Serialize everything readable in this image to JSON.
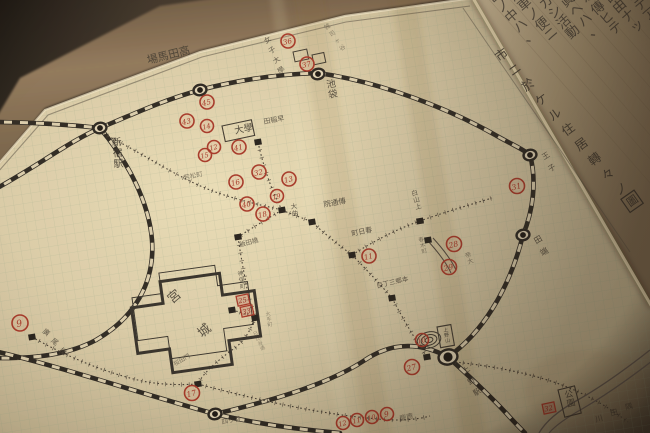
{
  "meta": {
    "width": 650,
    "height": 433,
    "scene": "photo of hand-drawn Tokyo residence map on graph paper over wooden desk, diary page with calligraphy at upper right"
  },
  "palette": {
    "wood": "#33291e",
    "paper": "#d5c6a2",
    "paper_bright": "#e8dbb6",
    "grid": "#8aa083",
    "ink": "#3a332a",
    "red": "#a33122",
    "pencil": "#5a5043",
    "diary_paper": "#a8967a"
  },
  "title": {
    "visible_chars": "市ニ於ケル住居轉々ノ",
    "boxed_char": "圖"
  },
  "calligraphy_columns": [
    "世ノ中ハ、",
    "汽車ノ便ニ",
    "シカシ活動",
    "寫眞ヘハ、",
    "所々傳ヒテ",
    "不自由ナッ",
    "タノデアル。"
  ],
  "palace": {
    "char1": "宮",
    "char2": "城"
  },
  "river_label": "川田隅",
  "railways": [
    {
      "d": "M -10 192 C 35 168 68 142 100 128 C 138 112 164 100 200 90 C 242 79 282 74 318 73"
    },
    {
      "d": "M -12 122 C 25 122 62 124 100 128"
    },
    {
      "d": "M 318 73 C 382 82 452 110 497 136 C 513 145 523 149 530 155 C 537 181 533 211 523 235 C 509 291 481 334 448 357"
    },
    {
      "d": "M 448 357 C 469 376 491 397 506 413 C 514 422 520 428 525 433"
    },
    {
      "d": "M 100 128 C 129 163 149 203 152 240 C 155 281 136 317 96 340 C 70 354 38 359 -8 358"
    },
    {
      "d": "M -10 350 C 60 366 142 394 215 414 C 262 425 304 430 340 433"
    },
    {
      "d": "M 215 414 C 280 399 332 382 365 360 C 392 342 420 342 448 357"
    }
  ],
  "trams": [
    {
      "d": "M 100 132 C 140 152 166 170 196 184 C 224 197 252 203 282 210"
    },
    {
      "d": "M 258 142 C 263 165 271 190 282 210"
    },
    {
      "d": "M 282 210 C 293 215 303 218 312 222 C 327 236 339 245 352 255 C 366 269 379 283 392 298 C 402 317 414 338 427 357"
    },
    {
      "d": "M 352 255 C 374 241 397 229 420 221 C 442 213 466 206 492 198"
    },
    {
      "d": "M 282 210 C 267 219 252 228 238 237"
    },
    {
      "d": "M 238 237 C 241 258 245 278 248 294 C 250 302 252 308 255 315 C 252 330 243 343 232 350 C 216 362 203 373 198 384"
    },
    {
      "d": "M 32 337 C 62 354 102 372 142 381 C 162 385 181 385 198 384"
    },
    {
      "d": "M 198 384 C 258 400 318 414 378 419 C 398 421 416 420 430 416"
    },
    {
      "d": "M 455 362 C 492 366 530 373 562 385 C 588 395 610 408 628 422"
    },
    {
      "d": "M 232 310 C 240 312 248 315 255 318"
    }
  ],
  "roads": [
    {
      "d": "M 428 241 C 438 252 446 262 451 273"
    },
    {
      "d": "M 433 238 C 443 249 451 259 456 270"
    }
  ],
  "river_paths": [
    {
      "d": "M 650 350 C 626 369 601 387 576 401 C 558 411 546 421 539 433"
    },
    {
      "d": "M 652 361 C 630 378 606 395 582 409 C 566 418 555 426 549 433"
    }
  ],
  "stations": [
    {
      "x": 100,
      "y": 128,
      "big": false
    },
    {
      "x": 200,
      "y": 90,
      "big": false
    },
    {
      "x": 318,
      "y": 74,
      "big": false
    },
    {
      "x": 530,
      "y": 155,
      "big": false
    },
    {
      "x": 523,
      "y": 235,
      "big": false
    },
    {
      "x": 448,
      "y": 357,
      "big": true
    },
    {
      "x": 215,
      "y": 414,
      "big": false
    }
  ],
  "junctions": [
    [
      32,
      337
    ],
    [
      258,
      142
    ],
    [
      282,
      210
    ],
    [
      238,
      237
    ],
    [
      312,
      222
    ],
    [
      352,
      255
    ],
    [
      420,
      221
    ],
    [
      428,
      240
    ],
    [
      392,
      298
    ],
    [
      232,
      310
    ],
    [
      255,
      318
    ],
    [
      427,
      357
    ],
    [
      198,
      384
    ]
  ],
  "red_circles": [
    {
      "x": 20,
      "y": 323,
      "n": "9",
      "r": 8
    },
    {
      "x": 192,
      "y": 393,
      "n": "17",
      "r": 7.5
    },
    {
      "x": 288,
      "y": 41,
      "n": "36",
      "r": 7
    },
    {
      "x": 307,
      "y": 64,
      "n": "37",
      "r": 7
    },
    {
      "x": 207,
      "y": 102,
      "n": "45",
      "r": 7
    },
    {
      "x": 187,
      "y": 121,
      "n": "43",
      "r": 7
    },
    {
      "x": 207,
      "y": 126,
      "n": "14",
      "r": 6.5
    },
    {
      "x": 214,
      "y": 147,
      "n": "12",
      "r": 6.5
    },
    {
      "x": 239,
      "y": 147,
      "n": "41",
      "r": 7
    },
    {
      "x": 205,
      "y": 155,
      "n": "15",
      "r": 6.5
    },
    {
      "x": 236,
      "y": 182,
      "n": "16",
      "r": 7
    },
    {
      "x": 259,
      "y": 172,
      "n": "32",
      "r": 7
    },
    {
      "x": 289,
      "y": 179,
      "n": "13",
      "r": 7
    },
    {
      "x": 277,
      "y": 196,
      "n": "19",
      "r": 6.5
    },
    {
      "x": 247,
      "y": 204,
      "n": "40",
      "r": 7
    },
    {
      "x": 263,
      "y": 214,
      "n": "18",
      "r": 7
    },
    {
      "x": 369,
      "y": 256,
      "n": "11",
      "r": 7
    },
    {
      "x": 454,
      "y": 244,
      "n": "28",
      "r": 7.5
    },
    {
      "x": 449,
      "y": 267,
      "n": "29",
      "r": 7.5
    },
    {
      "x": 517,
      "y": 186,
      "n": "31",
      "r": 7.5
    },
    {
      "x": 422,
      "y": 340,
      "n": "10",
      "r": 6.5
    },
    {
      "x": 412,
      "y": 367,
      "n": "27",
      "r": 7.5
    },
    {
      "x": 387,
      "y": 414,
      "n": "9",
      "r": 6.5
    },
    {
      "x": 372,
      "y": 417,
      "n": "10",
      "r": 6.5
    },
    {
      "x": 357,
      "y": 420,
      "n": "11",
      "r": 6.5
    },
    {
      "x": 343,
      "y": 423,
      "n": "12",
      "r": 6.5
    }
  ],
  "red_boxes": [
    {
      "x": 243,
      "y": 300,
      "n": "25"
    },
    {
      "x": 247,
      "y": 311,
      "n": "33"
    },
    {
      "x": 549,
      "y": 408,
      "n": "32"
    }
  ],
  "ink_boxes": [
    [
      293,
      52,
      14,
      10,
      -12
    ],
    [
      312,
      55,
      12,
      10,
      -12
    ]
  ],
  "boxed_labels": [
    {
      "t": "大學",
      "x": 222,
      "y": 126,
      "w": 30,
      "h": 16,
      "rot": -12,
      "s": 9.5,
      "dir": "h"
    },
    {
      "t": "公園",
      "x": 558,
      "y": 390,
      "w": 17,
      "h": 28,
      "rot": -14,
      "s": 8.5,
      "dir": "v"
    },
    {
      "t": "上野山",
      "x": 437,
      "y": 327,
      "w": 14,
      "h": 21,
      "rot": -10,
      "s": 5,
      "dir": "v"
    }
  ],
  "labels": [
    {
      "t": "場馬田高",
      "x": 148,
      "y": 64,
      "rot": -14,
      "s": 11,
      "dir": "h",
      "o": 0.85
    },
    {
      "t": "新宿駅",
      "x": 112,
      "y": 146,
      "rot": -5,
      "s": 10,
      "dir": "v",
      "o": 0.9
    },
    {
      "t": "池袋",
      "x": 327,
      "y": 88,
      "rot": -10,
      "s": 9.5,
      "dir": "v",
      "o": 0.85
    },
    {
      "t": "女子大學",
      "x": 266,
      "y": 44,
      "rot": 0,
      "s": 7,
      "dir": "d",
      "step": [
        4.5,
        10
      ],
      "crot": -35,
      "o": 0.8
    },
    {
      "t": "雑司ヶ谷",
      "x": 326,
      "y": 30,
      "rot": 0,
      "s": 6,
      "dir": "d",
      "step": [
        5,
        7
      ],
      "crot": -35,
      "o": 0.5
    },
    {
      "t": "田稲早",
      "x": 264,
      "y": 124,
      "rot": -10,
      "s": 7,
      "dir": "h",
      "o": 0.8
    },
    {
      "t": "若松町",
      "x": 184,
      "y": 180,
      "rot": -12,
      "s": 6.5,
      "dir": "h",
      "o": 0.6
    },
    {
      "t": "大曲",
      "x": 291,
      "y": 209,
      "rot": -8,
      "s": 6.5,
      "dir": "v",
      "o": 0.8
    },
    {
      "t": "飯田橋",
      "x": 240,
      "y": 247,
      "rot": -15,
      "s": 6.5,
      "dir": "h",
      "o": 0.75
    },
    {
      "t": "院通傳",
      "x": 324,
      "y": 207,
      "rot": -10,
      "s": 7.5,
      "dir": "h",
      "o": 0.85
    },
    {
      "t": "白山上",
      "x": 412,
      "y": 196,
      "rot": -15,
      "s": 6.5,
      "dir": "v",
      "o": 0.8
    },
    {
      "t": "町日春",
      "x": 352,
      "y": 236,
      "rot": -12,
      "s": 7,
      "dir": "h",
      "o": 0.85
    },
    {
      "t": "春木町",
      "x": 419,
      "y": 242,
      "rot": -15,
      "s": 5.5,
      "dir": "v",
      "o": 0.6
    },
    {
      "t": "目丁三郷本",
      "x": 377,
      "y": 288,
      "rot": -13,
      "s": 6.5,
      "dir": "h",
      "o": 0.8
    },
    {
      "t": "帝大",
      "x": 466,
      "y": 258,
      "rot": -20,
      "s": 6,
      "dir": "v",
      "o": 0.6
    },
    {
      "t": "神保町",
      "x": 238,
      "y": 276,
      "rot": -10,
      "s": 6,
      "dir": "v",
      "o": 0.75
    },
    {
      "t": "桜田門",
      "x": 175,
      "y": 366,
      "rot": -30,
      "s": 6,
      "dir": "h",
      "o": 0.6
    },
    {
      "t": "廣尾橋",
      "x": 42,
      "y": 332,
      "rot": 0,
      "s": 7,
      "dir": "d",
      "step": [
        8.5,
        9.5
      ],
      "crot": 38,
      "o": 0.8
    },
    {
      "t": "王子",
      "x": 544,
      "y": 160,
      "rot": 0,
      "s": 7.5,
      "dir": "d",
      "step": [
        6,
        12
      ],
      "crot": -33,
      "o": 0.8
    },
    {
      "t": "田端",
      "x": 536,
      "y": 244,
      "rot": 0,
      "s": 8,
      "dir": "d",
      "step": [
        6,
        12
      ],
      "crot": -30,
      "o": 0.85
    },
    {
      "t": "上野駅",
      "x": 464,
      "y": 374,
      "rot": 0,
      "s": 7.5,
      "dir": "d",
      "step": [
        5.5,
        11
      ],
      "crot": -30,
      "o": 0.85
    },
    {
      "t": "四ッ谷",
      "x": 222,
      "y": 424,
      "rot": -10,
      "s": 6.5,
      "dir": "h",
      "o": 0.7
    },
    {
      "t": "慶應",
      "x": 400,
      "y": 421,
      "rot": -12,
      "s": 7,
      "dir": "h",
      "o": 0.6
    },
    {
      "t": "大手町",
      "x": 266,
      "y": 316,
      "rot": -10,
      "s": 5,
      "dir": "v",
      "o": 0.5
    },
    {
      "t": "日比谷通",
      "x": 254,
      "y": 336,
      "rot": -25,
      "s": 5,
      "dir": "v",
      "o": 0.45
    },
    {
      "t": "川田隅",
      "x": 596,
      "y": 422,
      "rot": 0,
      "s": 7.5,
      "dir": "d",
      "step": [
        15,
        -6
      ],
      "crot": -15,
      "o": 0.8
    }
  ]
}
